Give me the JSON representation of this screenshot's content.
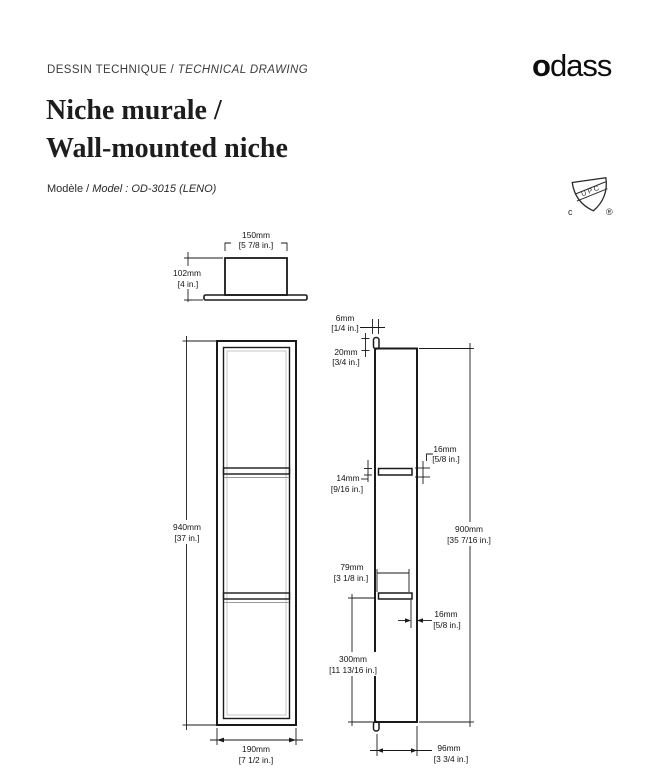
{
  "header": {
    "doc_label_fr": "DESSIN TECHNIQUE / ",
    "doc_label_en": "TECHNICAL DRAWING",
    "brand_first": "o",
    "brand_rest": "dass",
    "title_fr": "Niche murale /",
    "title_en": "Wall-mounted niche",
    "model_label": "Modèle / ",
    "model_value": "Model : OD-3015 (LENO)",
    "cert": {
      "band": "U P C",
      "left": "c",
      "right": "®"
    }
  },
  "drawing": {
    "dims": {
      "top_width": {
        "mm": "150mm",
        "in": "[5 7/8 in.]"
      },
      "top_depth": {
        "mm": "102mm",
        "in": "[4 in.]"
      },
      "front_height": {
        "mm": "940mm",
        "in": "[37 in.]"
      },
      "front_width": {
        "mm": "190mm",
        "in": "[7 1/2 in.]"
      },
      "lip": {
        "mm": "6mm",
        "in": "[1/4 in.]"
      },
      "top_offset": {
        "mm": "20mm",
        "in": "[3/4 in.]"
      },
      "shelf_thickness": {
        "mm": "14mm",
        "in": "[9/16 in.]"
      },
      "shelf_edge_upper": {
        "mm": "16mm",
        "in": "[5/8 in.]"
      },
      "inner_height": {
        "mm": "900mm",
        "in": "[35 7/16 in.]"
      },
      "shelf_depth": {
        "mm": "79mm",
        "in": "[3 1/8 in.]"
      },
      "shelf_edge_lower": {
        "mm": "16mm",
        "in": "[5/8 in.]"
      },
      "bottom_section": {
        "mm": "300mm",
        "in": "[11 13/16 in.]"
      },
      "body_depth": {
        "mm": "96mm",
        "in": "[3 3/4 in.]"
      }
    }
  }
}
